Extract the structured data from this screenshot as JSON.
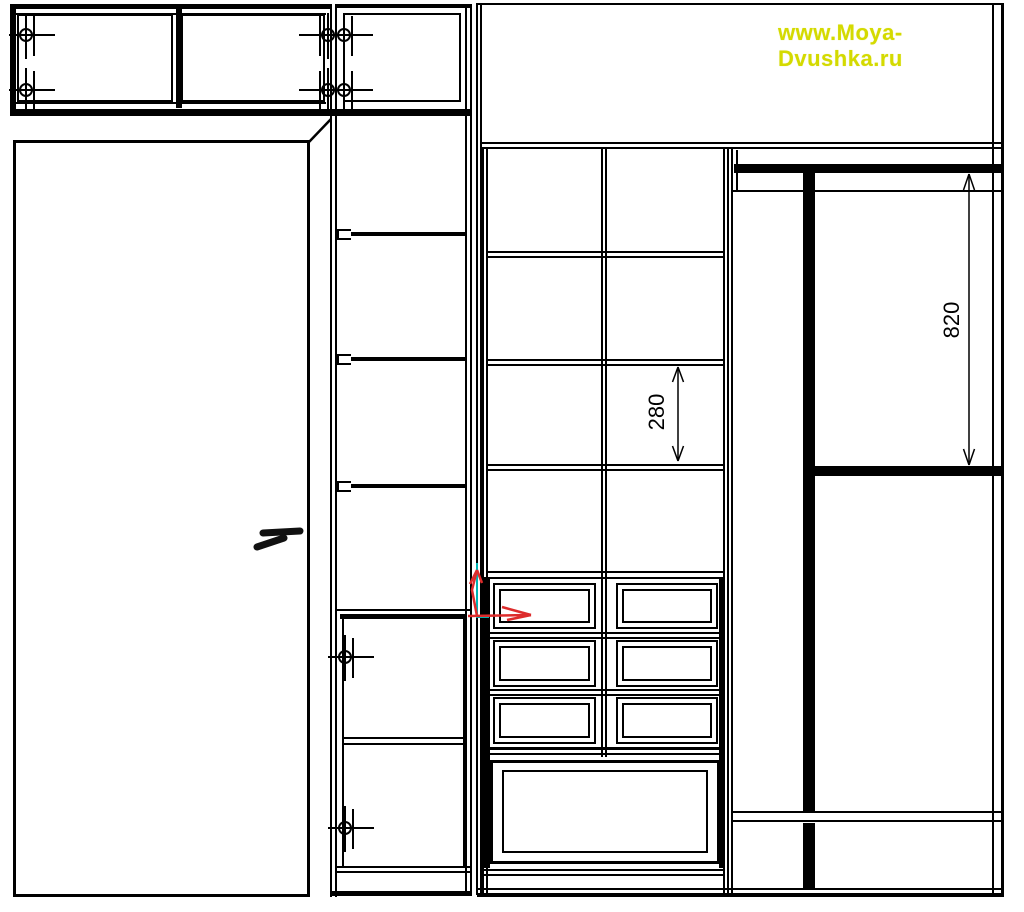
{
  "watermark": {
    "text": "www.Moya-Dvushka.ru",
    "color": "#d4da00"
  },
  "dimensions": {
    "center_shelf_spacing": {
      "value": "280",
      "unit": "mm-implied"
    },
    "hanging_clearance": {
      "value": "820",
      "unit": "mm-implied"
    }
  },
  "colors": {
    "line": "#000000",
    "background": "#ffffff",
    "watermark": "#d4da00",
    "axis_red": "#dd2c2c",
    "axis_cyan": "#00b4b4"
  },
  "icons": {
    "hinge": "hinge-icon",
    "ucs_axis": "ucs-axis-icon",
    "door_handle": "door-handle-icon"
  }
}
